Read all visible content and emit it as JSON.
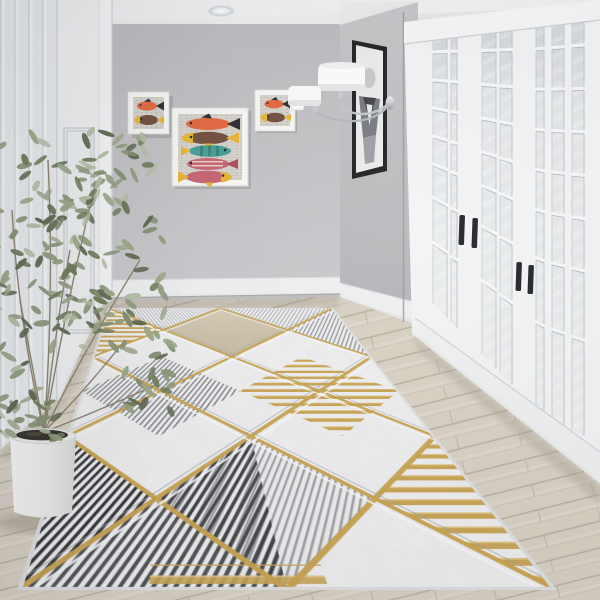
{
  "scene": {
    "type": "interior-photo",
    "description": "Bright hallway: gray textured walls, white paneled left wall with interior door, glazed white french doors on the right, fish-print artwork on the back wall, black framed portrait and chrome sconce on the right wall, potted olive plant in a white planter, light oak plank floor, and a large geometric area rug with a gold diamond lattice over gray hatched, black pinstriped, tan and white marble panels.",
    "room": {
      "ceiling": "white ceiling with crown molding and one recessed spotlight",
      "back_wall": "gray plaster textured wall",
      "right_wall": "gray sparkle accent wall",
      "left_wall": "white vertical paneling with white interior door and casing",
      "floor": "light oak planks laid diagonally"
    },
    "artworks": {
      "small_left": {
        "label": "small white-framed fish print",
        "fish_count": 2
      },
      "center": {
        "label": "white-framed fish print on newsprint background",
        "fish_count": 5
      },
      "small_right": {
        "label": "small white-framed fish print",
        "fish_count": 2
      },
      "portrait": {
        "label": "black-framed abstract portrait on right wall"
      }
    },
    "fixtures": {
      "sconce": "chrome wall sconce with two white drum shades",
      "light_switch": "white rocker switch plate",
      "spotlight": "recessed ceiling downlight"
    },
    "french_doors": {
      "label": "white glazed french doors with tall divided-lite panes",
      "handle_count": 4,
      "handle_color": "black"
    },
    "plant": {
      "label": "olive-green houseplant in white cylindrical planter with dark soil"
    },
    "rug": {
      "label": "geometric runner rug",
      "motifs": [
        "gold diamond lattice",
        "gold bar clusters",
        "gray diagonal hatching",
        "black pinstripe triangles",
        "tan marble diamond",
        "white marble ground"
      ]
    }
  },
  "palette": {
    "ceiling": "#f3f4f5",
    "back_wall": "#c6c5c7",
    "right_wall": "#bfbec1",
    "left_wall": "#eff1f2",
    "door_white": "#f4f5f6",
    "glass": "#e0e3e5",
    "floor_light": "#d8d1c3",
    "floor_line": "#b5ac9e",
    "rug_base": "#f2f2f3",
    "rug_gold": "#c9a24b",
    "rug_gray": "#73767b",
    "rug_dark": "#27292c",
    "rug_tan": "#d5c8ab",
    "fish_orange": "#e4643a",
    "fish_brown": "#6e4a38",
    "fish_yellow": "#e9b32e",
    "fish_teal": "#3f9d92",
    "fish_pink": "#c75f6e",
    "pot_white": "#f2f2f1",
    "soil_dark": "#2d2a23",
    "sconce_chrome": "#b9bcc0",
    "frame_black": "#1c1d1f",
    "leaf_greens": [
      "#99a585",
      "#7e8c6a",
      "#b3bca2",
      "#6a7753",
      "#8d9a7c",
      "#58644a"
    ]
  }
}
